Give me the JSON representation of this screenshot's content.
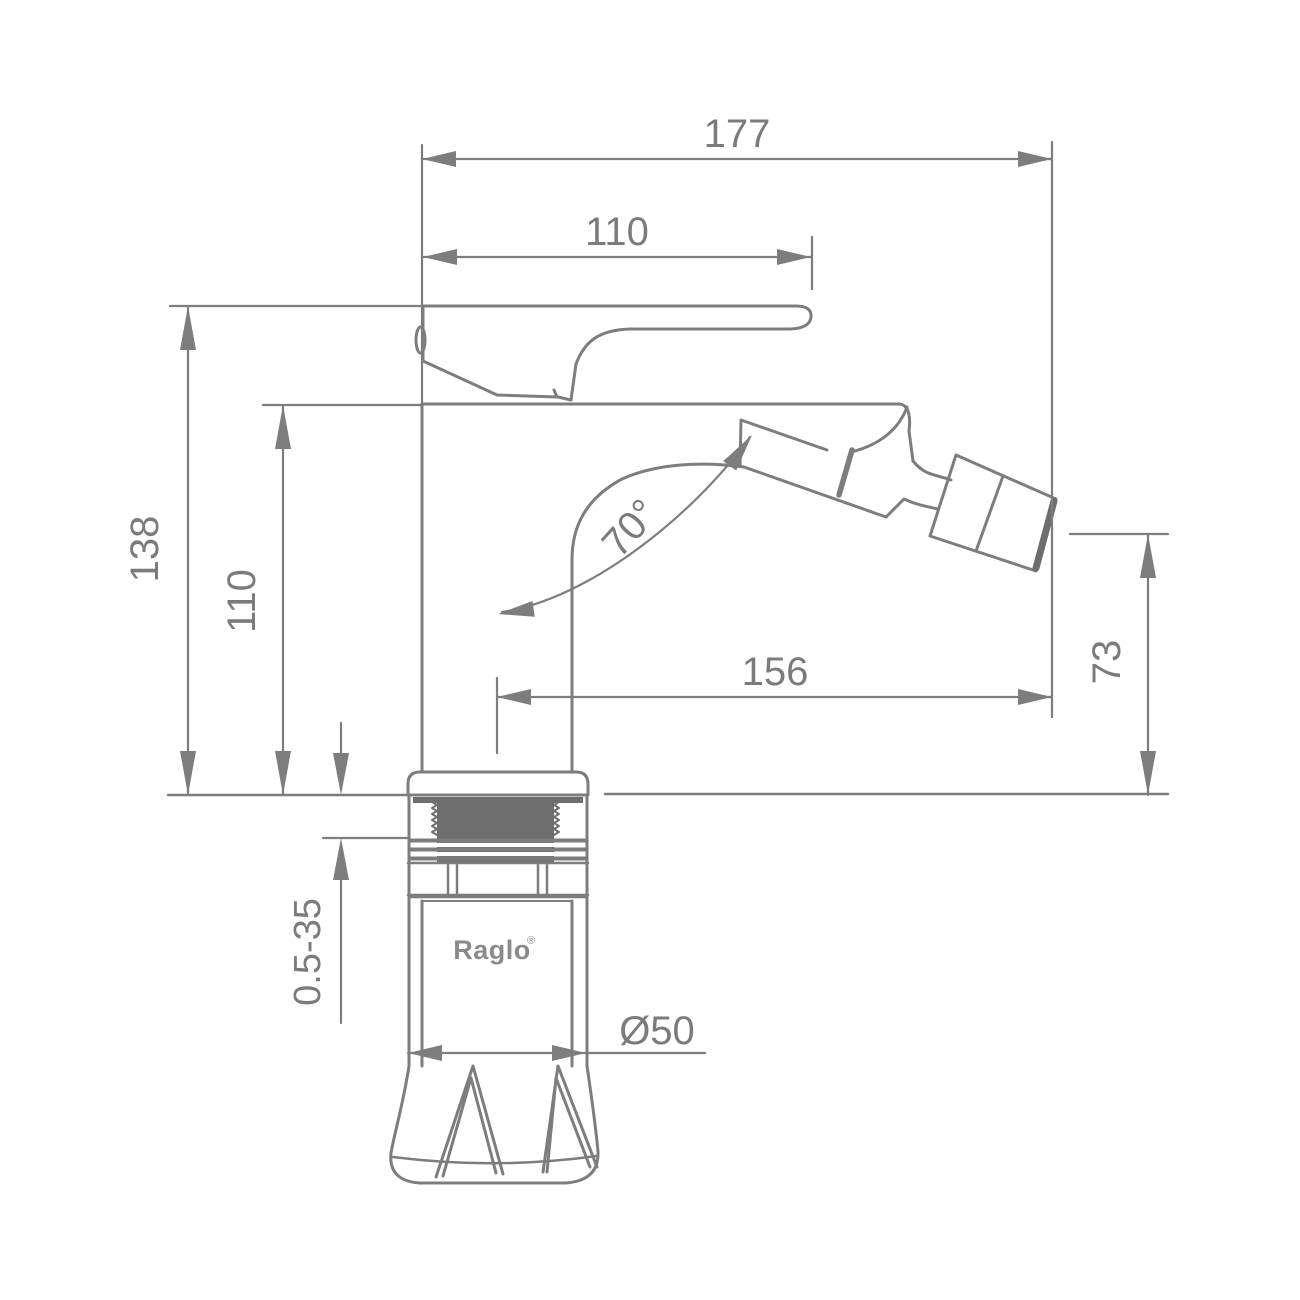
{
  "drawing": {
    "type": "technical-dimension-drawing",
    "subject": "bidet-mixer-faucet-side-view",
    "colors": {
      "background": "#ffffff",
      "line": "#7d7d7d",
      "dark_fill": "#6e6e6e",
      "text": "#7b7b7b",
      "brand_text": "#8a8a8a"
    },
    "brand": {
      "name": "Raglo",
      "mark": "®"
    },
    "dimensions": {
      "overall_width": {
        "label": "177"
      },
      "handle_length": {
        "label": "110"
      },
      "overall_height": {
        "label": "138"
      },
      "body_height": {
        "label": "110"
      },
      "spout_reach": {
        "label": "156"
      },
      "spray_height": {
        "label": "73"
      },
      "spray_angle": {
        "label": "70°"
      },
      "mounting_thickness": {
        "label": "0.5-35"
      },
      "base_diameter": {
        "label": "Ø50"
      }
    }
  }
}
